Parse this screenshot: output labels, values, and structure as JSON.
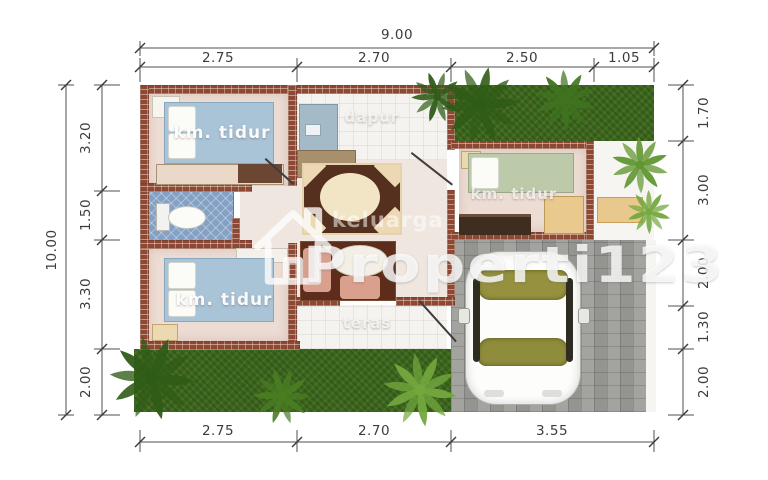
{
  "dimensions": {
    "top_total": "9.00",
    "top_segments": [
      "2.75",
      "2.70",
      "2.50",
      "1.05"
    ],
    "left_total": "10.00",
    "left_segments": [
      "3.20",
      "1.50",
      "3.30",
      "2.00"
    ],
    "right_segments": [
      "1.70",
      "3.00",
      "2.00",
      "1.30",
      "2.00"
    ],
    "bottom_segments": [
      "2.75",
      "2.70",
      "3.55"
    ]
  },
  "rooms": {
    "bedroom_top_left": "km. tidur",
    "bedroom_bottom_left": "km. tidur",
    "bedroom_right": "km. tidur",
    "kitchen": "dapur",
    "terrace": "teras"
  },
  "watermark": {
    "tagline": "keluarga",
    "brand": "Properti123",
    "logo": "house-logo"
  },
  "colors": {
    "wall_brick": "#8e4936",
    "grass": "#3c651f",
    "carport_paving": "#9d9d99",
    "bed_blue": "#a9c3d7",
    "bed_green": "#bccaa9",
    "bathroom_tile": "#84a0c4",
    "sofa_brown": "#5d2c1a",
    "cushion_salmon": "#d9a08e",
    "watermark_white": "#ffffff"
  }
}
